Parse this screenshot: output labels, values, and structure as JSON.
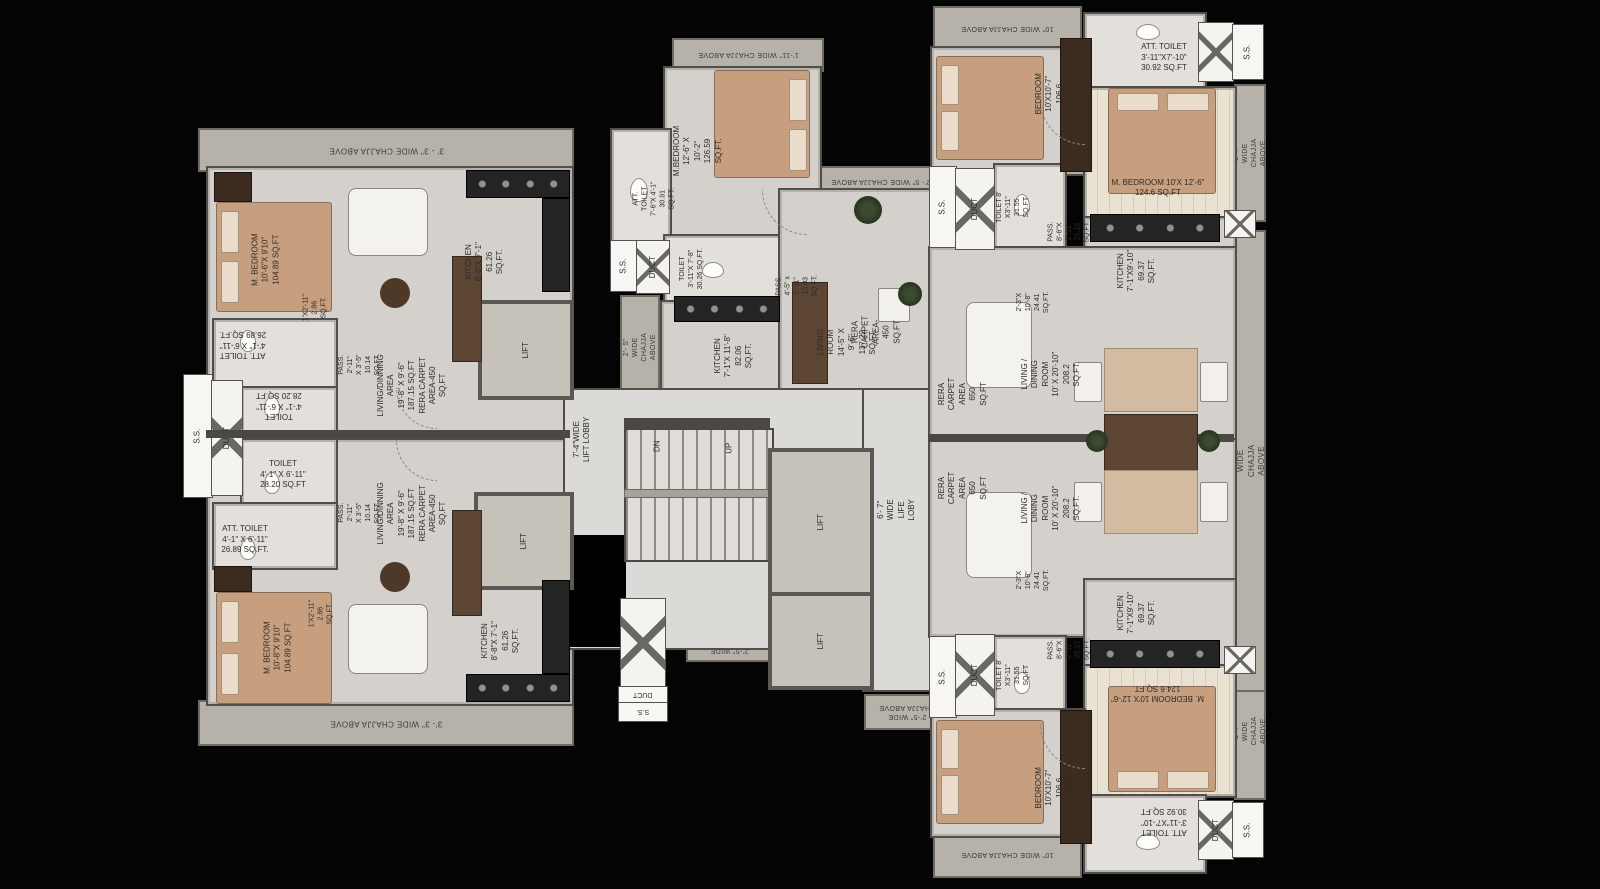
{
  "common": {
    "lift": "LIFT",
    "ss": "S.S.",
    "duct": "DUCT",
    "dn": "DN",
    "up": "UP"
  },
  "core": {
    "lift_lobby": "7'-4\"WIDE\nLIFT LOBBY",
    "life_loby": "6'- 7\" WIDE LIFE LOBY",
    "stair_chajja": "3'- 3\" WIDE\nCHAJJA\nABOVE",
    "chajja_bottom_left": "2'-5\" WIDE\nCHAJJA ABOVE",
    "chajja_bottom_right": "2'-5\" WIDE\nCHAJJA ABOVE"
  },
  "chajja": {
    "left_top": "3' - 3\" WIDE CHAJJA ABOVE",
    "left_bottom": "3'- 3\" WIDE CHAJJA ABOVE",
    "center_top": "1'-11\" WIDE CHAJJA ABOVE",
    "center_left": "2'- 5\" WIDE CHAJJA ABOVE",
    "center_right": "2'- 5\" WIDE CHAJJA ABOVE",
    "right_top": "10\" WIDE CHAJJA ABOVE",
    "right_bottom": "10\" WIDE CHAJJA ABOVE",
    "right_top_side": "1'-7\" WIDE CHAJJA ABOVE",
    "right_bottom_side": "1'-7\" WIDE CHAJJA ABOVE",
    "far_right": "2' -7\" WIDE CHAJJA ABOVE"
  },
  "unit_left_top": {
    "m_bedroom": "M. BEDROOM\n10'-6\"X 9'10\"\n104.89 SQ.FT",
    "niche": "1'X2'-11\"\n2.86 SQ.FT.",
    "att_toilet": "ATT. TOILET\n4'-1\" X 6'-11\"\n26.89 SQ.FT.",
    "toilet": "TOILET\n4'-1\" X 6'-11\"\n28.20 SQ.FT",
    "pass": "PASS.\n2'-11\"\nX 3'-5\"\n10.14\nSQ.FT.",
    "living": "LIVING/DINNING AREA\n19'-8\" X 9'-6\"\n187.15 SQ.FT\nRERA CARPET\nAREA-450 SQ.FT",
    "kitchen": "KITCHEN\n8'-8\"X 7'-1\"\n61.26 SQ.FT."
  },
  "unit_left_bottom": {
    "m_bedroom": "M. BEDROOM\n10'-8\"X 9'10\"\n104.89 SQ.FT",
    "niche": "1'X2'-11\"\n2.86 SQ.FT.",
    "att_toilet": "ATT. TOILET\n4'-1\" X 6'-11\"\n26.89 SQ.FT.",
    "toilet": "TOILET\n4'-1\" X 6'-11\"\n28.20 SQ.FT",
    "pass": "PASS.\n2'-11\"\nX 3'-5\"\n10.14\nSQ.FT.",
    "living": "LIVING/DINNING AREA\n19'-8\" X 9'-6\"\n187.15 SQ.FT\nRERA CARPET\nAREA-450 SQ.FT",
    "kitchen": "KITCHEN\n8'-8\"X 7'-1\"\n61.26 SQ.FT."
  },
  "unit_center": {
    "m_bedroom": "M.BEDROOM 12'-6\" X 10'-2\"\n126.59 SQ.FT.",
    "att_toilet": "ATT. TOILET\n7'-6\"X 4'-1\"\n30.91 SQ.FT.",
    "toilet": "TOILET\n3'-11\"X 7'-8\"\n30.26 SQ.FT.",
    "kitchen": "KITCHEN\n7'-1\"X 11'-8\"\n82.06 SQ.FT.",
    "pass": "PASS. 4'-5\" x 2'-11\"\n13.03 SQ.FT.",
    "living": "LIVING ROOM 14'-5\" X 9'-6\"\n137.22 SQ.FT.",
    "rera": "RERA CARPET\nAREA-450 SQ.FT"
  },
  "unit_right_top": {
    "bedroom": "BEDROOM 10'X10'-7\"\n106.6 SQ.FT.",
    "att_toilet": "ATT. TOILET\n3'-11\"X7'-10\"\n30.92 SQ.FT",
    "m_bedroom": "M. BEDROOM 10'X 12'-6\"\n124.6 SQ.FT",
    "toilet": "TOILET 8' X3'-11\"\n31.55 SQ.FT",
    "pass": "PASS. 8'-6\"X 2'-11\"\n25.13 SQ.FT.",
    "kitchen": "KITCHEN\n7'-1\"X9'-10\"\n69.37 SQ.FT.",
    "entry": "2'-3\"X 10'-8\"\n24.41 SQ.FT.",
    "rera": "RERA CARPET AREA\n650 SQ.FT",
    "living": "LIVING / DINING ROOM\n10' X 20'-10\"\n208.2 SQ.FT."
  },
  "unit_right_bottom": {
    "bedroom": "BEDROOM 10'X10'-7\"\n106.6 SQ.FT.",
    "att_toilet": "ATT. TOILET\n3'-11\"X7'-10\"\n30.92 SQ.FT",
    "m_bedroom": "M. BEDROOM 10'X 12'-6\"\n124.6 SQ.FT",
    "toilet": "TOILET 8' X3'-11\"\n31.55 SQ.FT",
    "pass": "PASS. 8'-6\"X 2'-11\"\n25.13 SQ.FT.",
    "kitchen": "KITCHEN\n7'-1\"X9'-10\"\n69.37 SQ.FT.",
    "entry": "2'-3\"X 10'-8\"\n24.41 SQ.FT.",
    "rera": "RERA CARPET AREA\n650 SQ.FT",
    "living": "LIVING / DINING ROOM\n10' X 20'-10\"\n208.2 SQ.FT."
  }
}
